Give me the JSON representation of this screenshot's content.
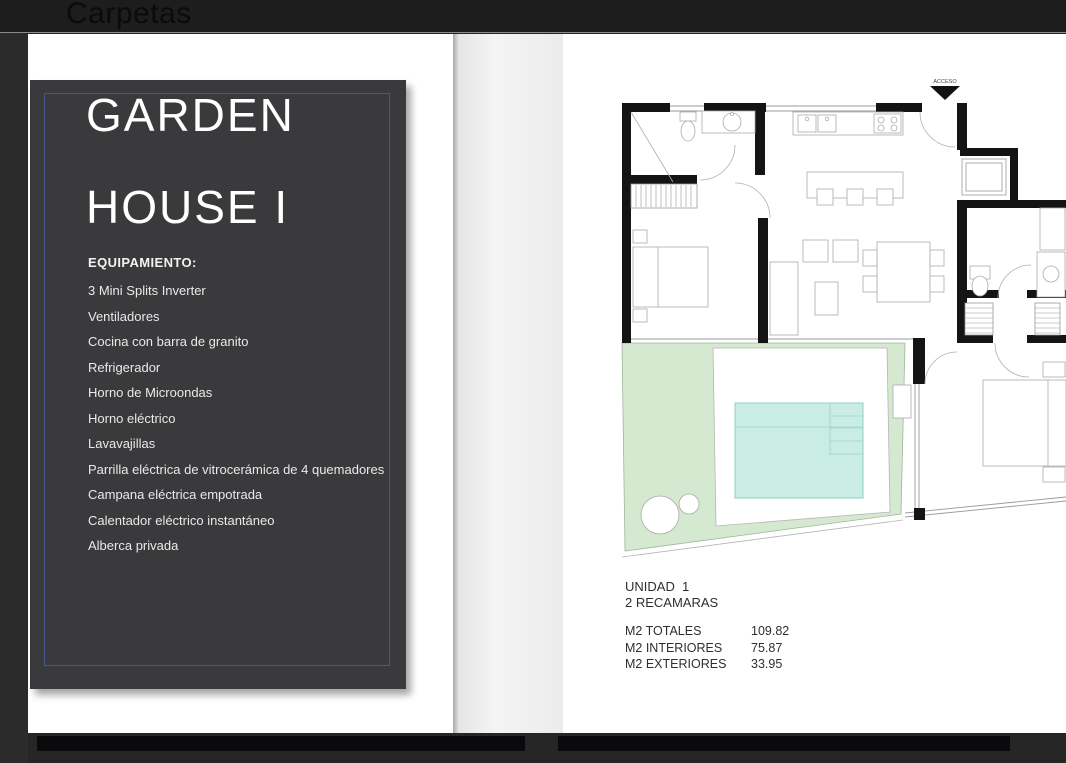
{
  "header": {
    "title": "Carpetas"
  },
  "left_page": {
    "title_line1": "GARDEN",
    "title_line2": "HOUSE I",
    "equipment_heading": "EQUIPAMIENTO:",
    "equipment_items": [
      "3 Mini Splits Inverter",
      "Ventiladores",
      "Cocina con barra de granito",
      "Refrigerador",
      "Horno de Microondas",
      "Horno eléctrico",
      "Lavavajillas",
      "Parrilla eléctrica de vitrocerámica de 4 quemadores",
      "Campana eléctrica empotrada",
      "Calentador eléctrico instantáneo",
      "Alberca privada"
    ]
  },
  "right_page": {
    "access_label": "ACCESO",
    "unit": {
      "line1": "UNIDAD  1",
      "line2": "2 RECAMARAS"
    },
    "areas": [
      {
        "label": "M2 TOTALES",
        "value": "109.82"
      },
      {
        "label": "M2 INTERIORES",
        "value": "75.87"
      },
      {
        "label": "M2 EXTERIORES",
        "value": "33.95"
      }
    ]
  },
  "colors": {
    "accent_border": "#46568e",
    "panel": "#3a3a3c",
    "garden": "#d5e9d0",
    "pool": "#c9ece4",
    "wall": "#141414"
  }
}
